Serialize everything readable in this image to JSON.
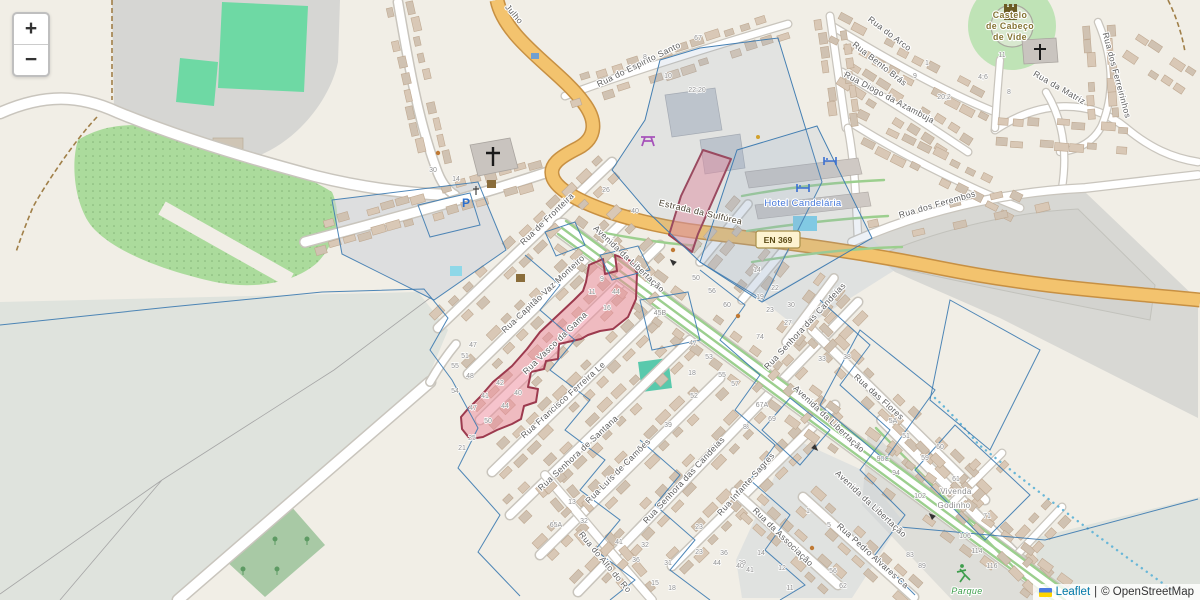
{
  "ui": {
    "zoom_in_label": "+",
    "zoom_out_label": "−",
    "attribution": {
      "leaflet_link": "Leaflet",
      "separator": "|",
      "osm_text": "© OpenStreetMap"
    }
  },
  "map": {
    "colors": {
      "pink_fill": "#ee8899",
      "pink_stroke": "#9c3a4e",
      "parcel_blue": "#3c7ab0",
      "road_orange": "#f3c36e",
      "road_orange_casing": "#c79043",
      "pitch_green": "#66d9a6",
      "link_blue": "#0078a8"
    },
    "place_labels": {
      "castle_line1": "Castelo",
      "castle_line2": "de Cabeço",
      "castle_line3": "de Vide",
      "hotel": "Hotel Candelária",
      "route_ref": "EN 369",
      "vivenda_line1": "Vivenda",
      "vivenda_line2": "Godinho",
      "park": "Parque"
    },
    "street_labels": {
      "julho": "Julho",
      "espirito_santo": "Rua do Espirito Santo",
      "arco": "Rua do Arco",
      "bento_bras": "Rua Bento Brás",
      "diogo_azambuja": "Rua Diogo da Azambuja",
      "matriz": "Rua da Matriz",
      "ferreirinhos": "Rua dos Ferreirinhos",
      "ferembos": "Rua dos Ferembos",
      "estrada_sulfurea": "Estrada da Sulfúrea",
      "fronteira": "Rua de Fronteira",
      "capitao_vaz": "Rua Capitão Vaz Monteiro",
      "avenida": "Avenida da Libertação",
      "vasco_gama": "Rua Vasco da Gama",
      "francisco_ferreira": "Rua Francisco Ferreira Le",
      "senhora_santana": "Rua Senhora de Santana",
      "luis_camoes": "Rua Luís de Camões",
      "senhora_candeias": "Rua Senhora das Candeias",
      "infante_sagres": "Rua Infante Sagres",
      "associacao": "Rua da Associação",
      "flores": "Rua das Flores",
      "pedro_alvares": "Rua Pedro Alvares Ca",
      "alto": "Rua do Alto do Ro"
    },
    "house_numbers": [
      {
        "x": 698,
        "y": 40,
        "t": "67"
      },
      {
        "x": 645,
        "y": 59,
        "t": "8"
      },
      {
        "x": 668,
        "y": 78,
        "t": "10"
      },
      {
        "x": 697,
        "y": 92,
        "t": "22;20"
      },
      {
        "x": 433,
        "y": 172,
        "t": "30"
      },
      {
        "x": 456,
        "y": 181,
        "t": "14"
      },
      {
        "x": 915,
        "y": 78,
        "t": "9"
      },
      {
        "x": 927,
        "y": 65,
        "t": "1"
      },
      {
        "x": 944,
        "y": 99,
        "t": "20;2"
      },
      {
        "x": 1002,
        "y": 57,
        "t": "11"
      },
      {
        "x": 983,
        "y": 79,
        "t": "4;6"
      },
      {
        "x": 1009,
        "y": 94,
        "t": "8"
      },
      {
        "x": 606,
        "y": 192,
        "t": "26"
      },
      {
        "x": 635,
        "y": 213,
        "t": "40"
      },
      {
        "x": 660,
        "y": 315,
        "t": "45B"
      },
      {
        "x": 696,
        "y": 280,
        "t": "50"
      },
      {
        "x": 712,
        "y": 293,
        "t": "56"
      },
      {
        "x": 727,
        "y": 307,
        "t": "60"
      },
      {
        "x": 757,
        "y": 272,
        "t": "14"
      },
      {
        "x": 775,
        "y": 290,
        "t": "22"
      },
      {
        "x": 760,
        "y": 299,
        "t": "19"
      },
      {
        "x": 770,
        "y": 312,
        "t": "23"
      },
      {
        "x": 791,
        "y": 307,
        "t": "30"
      },
      {
        "x": 788,
        "y": 325,
        "t": "27"
      },
      {
        "x": 760,
        "y": 339,
        "t": "74"
      },
      {
        "x": 822,
        "y": 361,
        "t": "33"
      },
      {
        "x": 847,
        "y": 359,
        "t": "38"
      },
      {
        "x": 693,
        "y": 345,
        "t": "47"
      },
      {
        "x": 709,
        "y": 359,
        "t": "53"
      },
      {
        "x": 722,
        "y": 377,
        "t": "55"
      },
      {
        "x": 735,
        "y": 386,
        "t": "57"
      },
      {
        "x": 692,
        "y": 375,
        "t": "18"
      },
      {
        "x": 694,
        "y": 398,
        "t": "52"
      },
      {
        "x": 762,
        "y": 407,
        "t": "67A"
      },
      {
        "x": 772,
        "y": 421,
        "t": "69"
      },
      {
        "x": 747,
        "y": 429,
        "t": "8"
      },
      {
        "x": 893,
        "y": 423,
        "t": "5A"
      },
      {
        "x": 906,
        "y": 438,
        "t": "51"
      },
      {
        "x": 883,
        "y": 461,
        "t": "90C"
      },
      {
        "x": 602,
        "y": 281,
        "t": "9"
      },
      {
        "x": 592,
        "y": 294,
        "t": "11"
      },
      {
        "x": 616,
        "y": 294,
        "t": "44"
      },
      {
        "x": 607,
        "y": 310,
        "t": "16"
      },
      {
        "x": 473,
        "y": 347,
        "t": "47"
      },
      {
        "x": 465,
        "y": 358,
        "t": "51"
      },
      {
        "x": 455,
        "y": 368,
        "t": "55"
      },
      {
        "x": 470,
        "y": 378,
        "t": "48"
      },
      {
        "x": 455,
        "y": 393,
        "t": "54"
      },
      {
        "x": 500,
        "y": 385,
        "t": "42"
      },
      {
        "x": 485,
        "y": 398,
        "t": "41"
      },
      {
        "x": 473,
        "y": 410,
        "t": "47"
      },
      {
        "x": 505,
        "y": 408,
        "t": "44"
      },
      {
        "x": 488,
        "y": 423,
        "t": "50"
      },
      {
        "x": 518,
        "y": 395,
        "t": "40"
      },
      {
        "x": 472,
        "y": 440,
        "t": "25"
      },
      {
        "x": 462,
        "y": 450,
        "t": "21"
      },
      {
        "x": 668,
        "y": 427,
        "t": "39"
      },
      {
        "x": 745,
        "y": 429,
        "t": "8"
      },
      {
        "x": 572,
        "y": 504,
        "t": "13"
      },
      {
        "x": 584,
        "y": 523,
        "t": "32"
      },
      {
        "x": 556,
        "y": 527,
        "t": "65A"
      },
      {
        "x": 619,
        "y": 544,
        "t": "41"
      },
      {
        "x": 636,
        "y": 562,
        "t": "36"
      },
      {
        "x": 668,
        "y": 565,
        "t": "31"
      },
      {
        "x": 645,
        "y": 547,
        "t": "32"
      },
      {
        "x": 699,
        "y": 529,
        "t": "23"
      },
      {
        "x": 699,
        "y": 554,
        "t": "23"
      },
      {
        "x": 717,
        "y": 565,
        "t": "44"
      },
      {
        "x": 742,
        "y": 565,
        "t": "29"
      },
      {
        "x": 724,
        "y": 555,
        "t": "36"
      },
      {
        "x": 761,
        "y": 555,
        "t": "14"
      },
      {
        "x": 782,
        "y": 570,
        "t": "12"
      },
      {
        "x": 655,
        "y": 585,
        "t": "15"
      },
      {
        "x": 672,
        "y": 590,
        "t": "18"
      },
      {
        "x": 750,
        "y": 572,
        "t": "41"
      },
      {
        "x": 790,
        "y": 590,
        "t": "11"
      },
      {
        "x": 808,
        "y": 513,
        "t": "1"
      },
      {
        "x": 829,
        "y": 527,
        "t": "5"
      },
      {
        "x": 833,
        "y": 573,
        "t": "56"
      },
      {
        "x": 843,
        "y": 588,
        "t": "62"
      },
      {
        "x": 740,
        "y": 568,
        "t": "40"
      },
      {
        "x": 896,
        "y": 475,
        "t": "94"
      },
      {
        "x": 920,
        "y": 498,
        "t": "102"
      },
      {
        "x": 956,
        "y": 481,
        "t": "61"
      },
      {
        "x": 965,
        "y": 538,
        "t": "106"
      },
      {
        "x": 977,
        "y": 553,
        "t": "114"
      },
      {
        "x": 992,
        "y": 568,
        "t": "116"
      },
      {
        "x": 910,
        "y": 557,
        "t": "83"
      },
      {
        "x": 922,
        "y": 568,
        "t": "89"
      },
      {
        "x": 940,
        "y": 449,
        "t": "60"
      },
      {
        "x": 925,
        "y": 460,
        "t": "59"
      },
      {
        "x": 987,
        "y": 518,
        "t": "71"
      }
    ]
  }
}
